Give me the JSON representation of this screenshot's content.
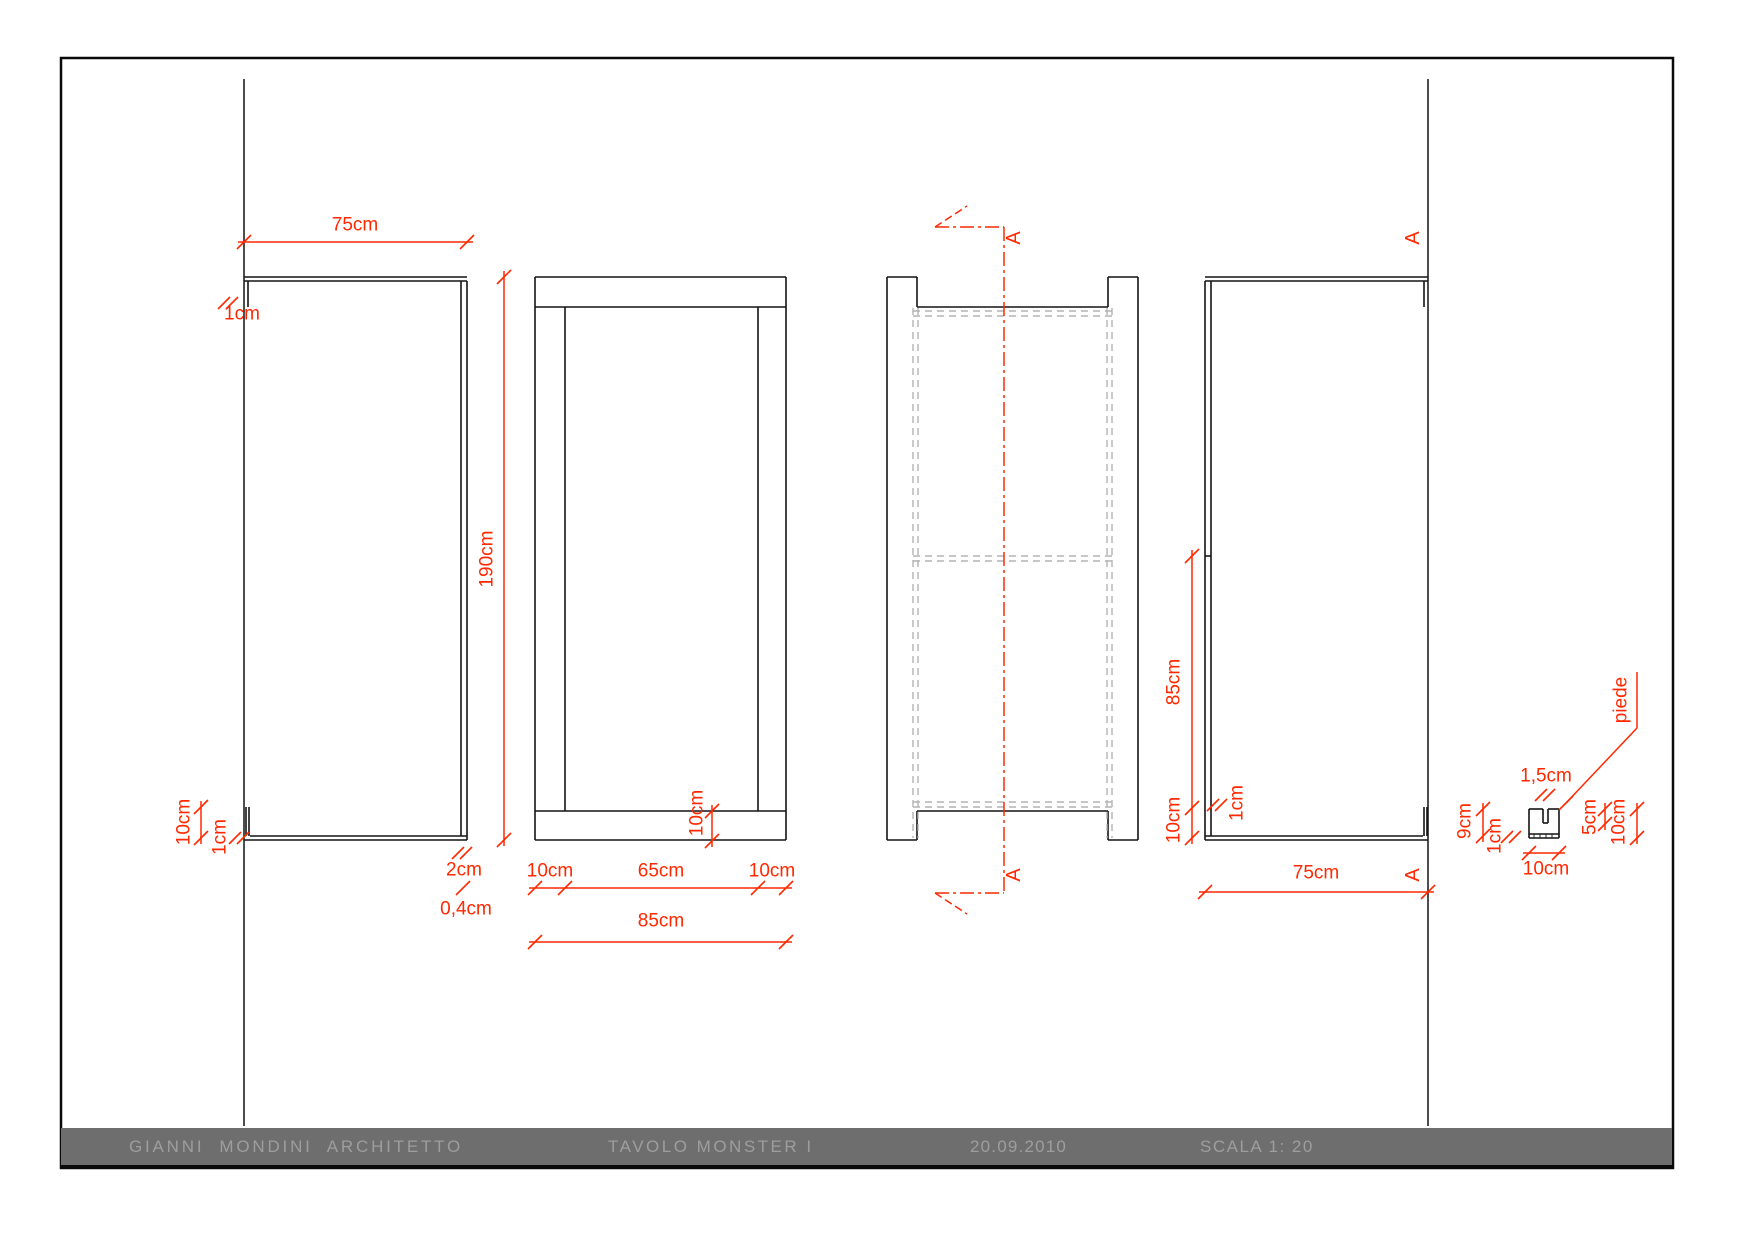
{
  "colors": {
    "dimension_red": "#ff2800",
    "hidden_line_gray": "#b3b3b3",
    "drawing_black": "#141414",
    "titlebar_gray": "#6e6e6e",
    "titlebar_text": "#9e9e9e"
  },
  "footer": {
    "architect": "GIANNI  MONDINI  ARCHITETTO",
    "project": "TAVOLO MONSTER I",
    "date": "20.09.2010",
    "scale": "SCALA 1: 20"
  },
  "views": {
    "front": {
      "width": "75cm",
      "top_reveal": "1cm",
      "foot_height": "10cm",
      "foot_width": "1cm",
      "edge_thickness": "2cm",
      "edge_gap": "0,4cm"
    },
    "side": {
      "height": "190cm",
      "bottom_left": "10cm",
      "bottom_center": "65cm",
      "bottom_right": "10cm",
      "bottom_total": "85cm",
      "slab_thickness": "10cm"
    },
    "section": {
      "marker_top": "A",
      "marker_bottom": "A"
    },
    "back": {
      "inner_height": "85cm",
      "slab_thickness": "10cm",
      "foot_width": "1cm",
      "width": "75cm",
      "marker_top": "A",
      "marker_bottom": "A"
    },
    "foot_detail": {
      "title": "piede",
      "notch_width": "1,5cm",
      "body_height": "9cm",
      "plate_thickness": "1cm",
      "notch_depth": "5cm",
      "total_height": "10cm",
      "total_width": "10cm"
    }
  }
}
